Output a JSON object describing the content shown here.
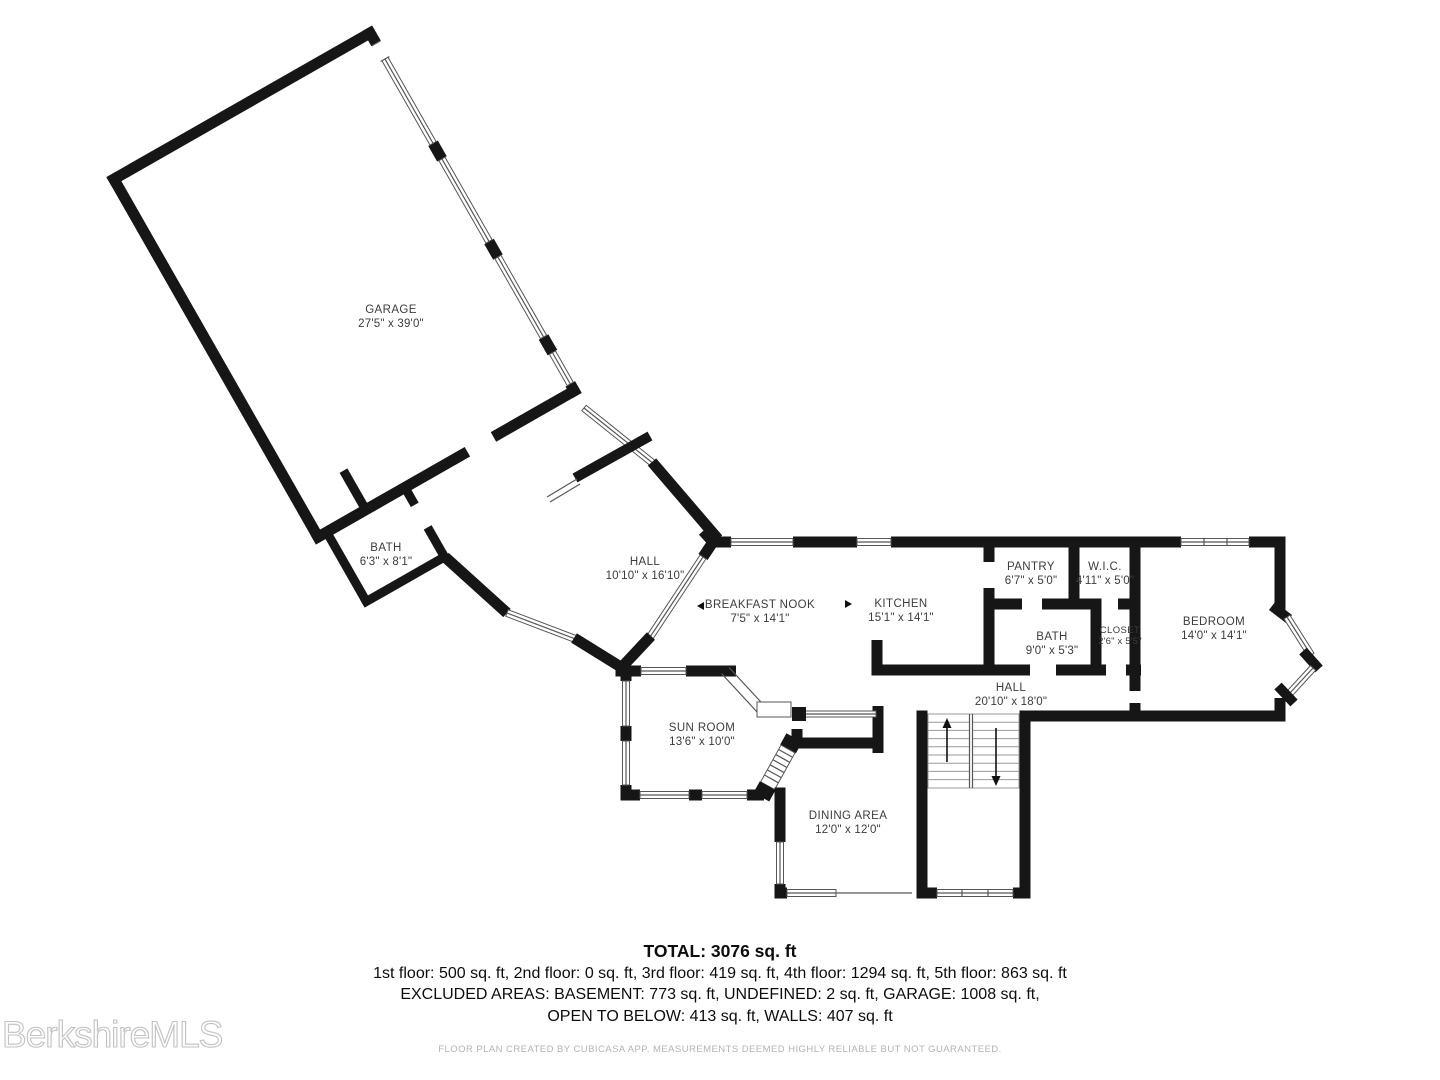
{
  "floor_plan": {
    "rooms": [
      {
        "id": "garage",
        "name": "GARAGE",
        "dims": "27'5\" x 39'0\""
      },
      {
        "id": "bath-garage",
        "name": "BATH",
        "dims": "6'3\" x 8'1\""
      },
      {
        "id": "hall-upper",
        "name": "HALL",
        "dims": "10'10\" x 16'10\""
      },
      {
        "id": "breakfast-nook",
        "name": "BREAKFAST NOOK",
        "dims": "7'5\" x 14'1\""
      },
      {
        "id": "kitchen",
        "name": "KITCHEN",
        "dims": "15'1\" x 14'1\""
      },
      {
        "id": "pantry",
        "name": "PANTRY",
        "dims": "6'7\" x 5'0\""
      },
      {
        "id": "wic",
        "name": "W.I.C.",
        "dims": "4'11\" x 5'0\""
      },
      {
        "id": "bath-main",
        "name": "BATH",
        "dims": "9'0\" x 5'3\""
      },
      {
        "id": "closet",
        "name": "CLOSET",
        "dims": "2'6\" x 5'5\""
      },
      {
        "id": "bedroom",
        "name": "BEDROOM",
        "dims": "14'0\" x 14'1\""
      },
      {
        "id": "hall-lower",
        "name": "HALL",
        "dims": "20'10\" x 18'0\""
      },
      {
        "id": "sun-room",
        "name": "SUN ROOM",
        "dims": "13'6\" x 10'0\""
      },
      {
        "id": "dining-area",
        "name": "DINING AREA",
        "dims": "12'0\" x 12'0\""
      }
    ],
    "summary": {
      "total": "TOTAL: 3076 sq. ft",
      "floors": "1st floor: 500 sq. ft, 2nd floor: 0 sq. ft, 3rd floor: 419 sq. ft, 4th floor: 1294 sq. ft, 5th floor: 863 sq. ft",
      "excluded_line1": "EXCLUDED AREAS: BASEMENT: 773 sq. ft, UNDEFINED: 2 sq. ft, GARAGE: 1008 sq. ft,",
      "excluded_line2": "OPEN TO BELOW: 413 sq. ft, WALLS: 407 sq. ft"
    },
    "disclaimer": "FLOOR PLAN CREATED BY CUBICASA APP. MEASUREMENTS DEEMED HIGHLY RELIABLE BUT NOT GUARANTEED.",
    "watermark": "BerkshireMLS",
    "colors": {
      "wall": "#161616",
      "window_line": "#565656",
      "label": "#3c3c3c",
      "accent_none": "#ffffff"
    }
  }
}
